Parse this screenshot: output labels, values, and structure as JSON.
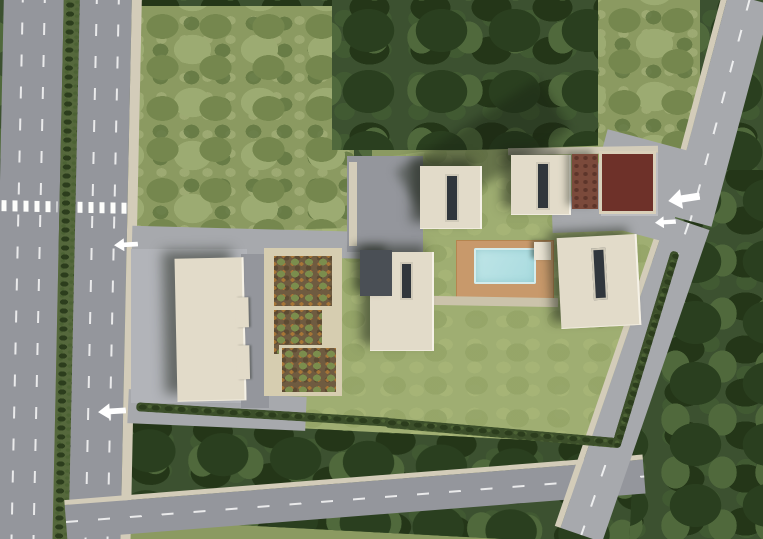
{
  "site_plan": {
    "watermark": "TEKCE",
    "office_label": "OFİS",
    "blocks": [
      {
        "id": "a-blok",
        "label": "A BLOK"
      },
      {
        "id": "b-blok",
        "label": "B BLOK"
      },
      {
        "id": "c-blok",
        "label": "C BLOK"
      },
      {
        "id": "d-blok",
        "label": "D BLOK"
      }
    ],
    "entrances": [
      {
        "id": "kapali-otopark-girisi-left",
        "label": "Kapalı Otopark Girişi",
        "arrow_icon": "arrow-left-icon"
      },
      {
        "id": "kapali-otopark-girisi-right",
        "label": "Kapalı Otopark Girişi",
        "arrow_icon": "arrow-left-icon"
      },
      {
        "id": "acik-otopark-girisi",
        "label": "Açık Otopark Girişi",
        "arrow_icon": "arrow-left-icon"
      },
      {
        "id": "site-girisi",
        "label": "Site Girişi",
        "arrow_icon": "arrow-left-icon"
      }
    ],
    "colors": {
      "asphalt": "#94969c",
      "asphalt_light": "#a7a9ad",
      "sidewalk": "#d3ccb9",
      "lawn": "#9fae72",
      "forest": "#3c5130",
      "scrub": "#8b9a61",
      "building_beige": "#e2dbc9",
      "roof_dark": "#4a4f55",
      "red_roof": "#6e3129",
      "red_terrace": "#7b4a3b",
      "pool_water": "#a9dbdf",
      "deck_tan": "#c8996b",
      "garden_soil": "#6f5b40",
      "garden_path": "#d6cdb0",
      "hedge": "#3c4f2a",
      "median_green": "#55683c",
      "label_text": "#ffffff"
    }
  }
}
